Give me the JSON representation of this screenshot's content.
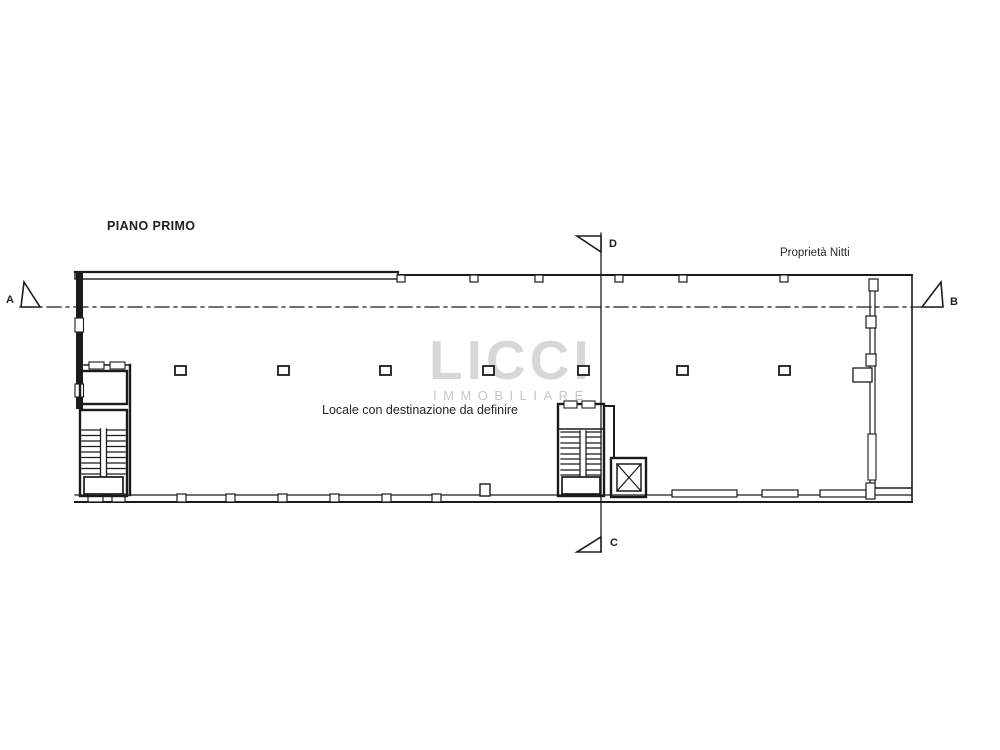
{
  "canvas": {
    "background": "#ffffff",
    "line_color": "#1b1b1b"
  },
  "plan": {
    "title": "PIANO PRIMO",
    "property_label": "Proprietà Nitti",
    "room_label": "Locale con destinazione da definire"
  },
  "section_markers": {
    "a": "A",
    "b": "B",
    "c": "C",
    "d": "D"
  },
  "watermark": {
    "logo": "LICCI",
    "subtitle": "IMMOBILIARE",
    "logo_color": "#d7d7d7",
    "subtitle_color": "#c6c6c6"
  }
}
